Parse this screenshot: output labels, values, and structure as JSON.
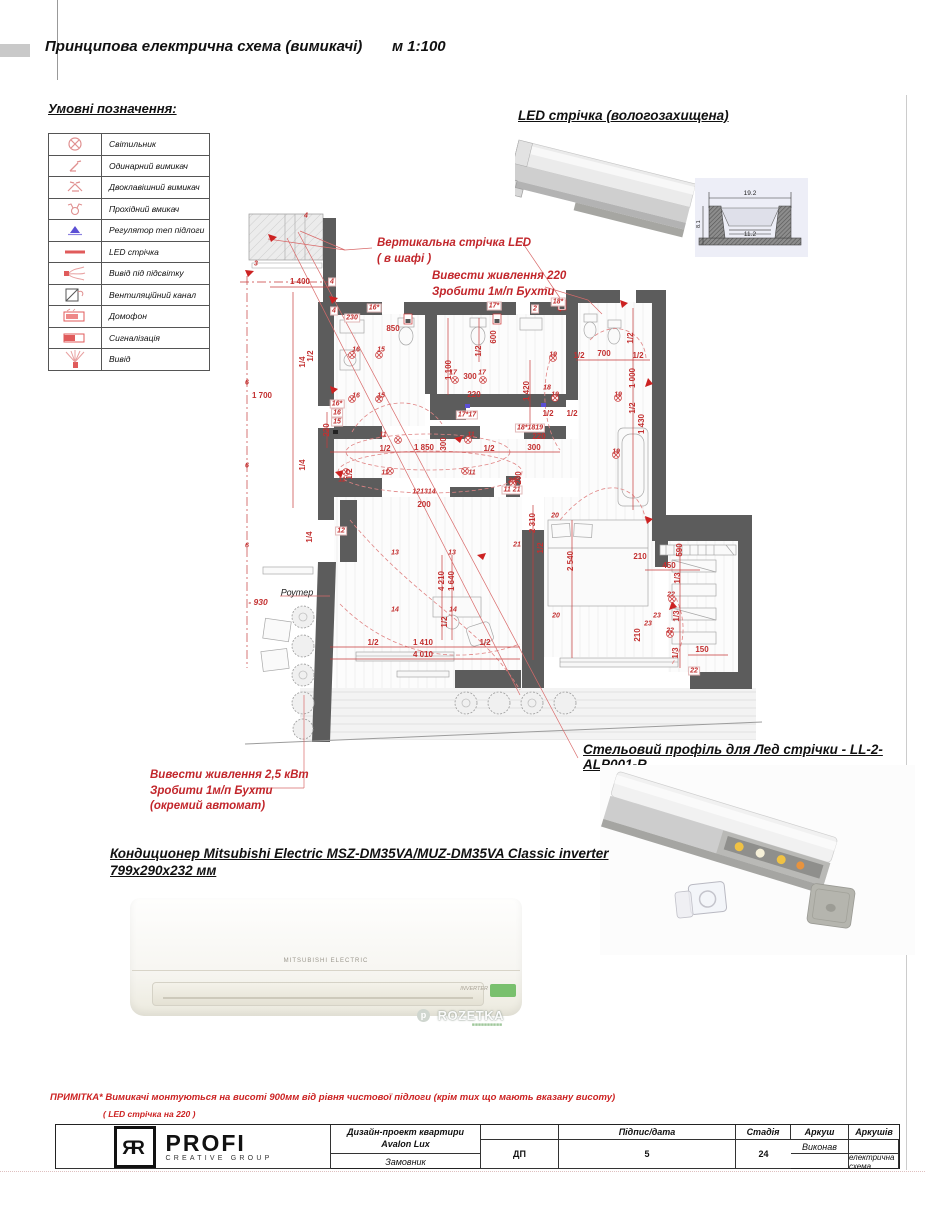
{
  "page": {
    "title": "Принципова електрична схема (вимикачі)",
    "scale": "м 1:100"
  },
  "legend": {
    "title": "Умовні позначення:",
    "items": [
      {
        "icon": "light-fixture-icon",
        "label": "Світильник"
      },
      {
        "icon": "single-switch-icon",
        "label": "Одинарний вимикач"
      },
      {
        "icon": "double-switch-icon",
        "label": "Двоклавішний вимикач"
      },
      {
        "icon": "pass-switch-icon",
        "label": "Прохідний вмикач"
      },
      {
        "icon": "floor-heating-regulator-icon",
        "label": "Регулятор теп підлоги"
      },
      {
        "icon": "led-strip-icon",
        "label": "LED стрічка"
      },
      {
        "icon": "backlight-output-icon",
        "label": "Вивід під підсвітку"
      },
      {
        "icon": "vent-channel-icon",
        "label": "Вентиляційний канал"
      },
      {
        "icon": "intercom-icon",
        "label": "Домофон"
      },
      {
        "icon": "alarm-icon",
        "label": "Сигналізація"
      },
      {
        "icon": "output-icon",
        "label": "Вивід"
      }
    ]
  },
  "led_strip": {
    "heading": "LED стрічка (вологозахищена)",
    "cross_section": {
      "width_top": "19.2",
      "width_inner": "11.2",
      "height": "8.1"
    }
  },
  "ceiling_profile": {
    "heading": "Стельовий профіль для Лед стрічки -  LL-2-ALP001-R"
  },
  "ac_unit": {
    "heading_line1": "Кондиционер Mitsubishi Electric MSZ-DM35VA/MUZ-DM35VA Classic inverter",
    "heading_line2": "799х290х232 мм",
    "brand": "MITSUBISHI ELECTRIC",
    "inverter_label": "INVERTER",
    "watermark": "ROZETKA"
  },
  "note": {
    "line1": "ПРИМІТКА*  Вимикачі монтуються на висоті 900мм від рівня чистової підлоги (крім тих що мають вказану висоту)",
    "line2": "( LED стрічка на 220 )"
  },
  "title_block": {
    "logo_monogram": "ЯR",
    "logo_name": "PROFI",
    "logo_sub": "CREATIVE GROUP",
    "executor_label": "Виконав",
    "customer_label": "Замовник",
    "signature_label": "Підпис/дата",
    "project_line1": "Дизайн-проект квартири",
    "project_line2": "Avalon Lux",
    "sheet_title": "Принципова електрична схема (вимикачі)",
    "stage_label": "Стадія",
    "stage_value": "ДП",
    "sheet_label": "Аркуш",
    "sheet_value": "5",
    "sheets_label": "Аркушів",
    "sheets_value": "24"
  },
  "plan": {
    "router_label": "Роутер",
    "level_label": "- 930",
    "callouts": [
      {
        "id": "vertical-led",
        "lines": [
          "Вертикальна стрічка LED",
          "( в шафі )"
        ]
      },
      {
        "id": "power-220",
        "lines": [
          "Вивести живлення 220",
          "Зробити 1м/п Бухти"
        ]
      },
      {
        "id": "power-25",
        "lines": [
          "Вивести живлення 2,5 кВт",
          "Зробити 1м/п Бухти",
          "(окремий автомат)"
        ]
      }
    ],
    "labels": [
      {
        "x": 300,
        "y": 282,
        "t": "1 400"
      },
      {
        "x": 352,
        "y": 318,
        "t": "230",
        "k": "bx"
      },
      {
        "x": 393,
        "y": 329,
        "t": "850"
      },
      {
        "x": 262,
        "y": 396,
        "t": "1 700"
      },
      {
        "x": 604,
        "y": 354,
        "t": "700"
      },
      {
        "x": 579,
        "y": 356,
        "t": "1/2"
      },
      {
        "x": 638,
        "y": 356,
        "t": "1/2"
      },
      {
        "x": 470,
        "y": 377,
        "t": "300"
      },
      {
        "x": 474,
        "y": 395,
        "t": "220"
      },
      {
        "x": 424,
        "y": 448,
        "t": "1 850"
      },
      {
        "x": 385,
        "y": 449,
        "t": "1/2"
      },
      {
        "x": 489,
        "y": 449,
        "t": "1/2"
      },
      {
        "x": 548,
        "y": 414,
        "t": "1/2"
      },
      {
        "x": 572,
        "y": 414,
        "t": "1/2"
      },
      {
        "x": 539,
        "y": 437,
        "t": "220"
      },
      {
        "x": 534,
        "y": 448,
        "t": "300"
      },
      {
        "x": 424,
        "y": 505,
        "t": "200"
      },
      {
        "x": 640,
        "y": 557,
        "t": "210"
      },
      {
        "x": 669,
        "y": 566,
        "t": "450"
      },
      {
        "x": 702,
        "y": 650,
        "t": "150"
      },
      {
        "x": 373,
        "y": 643,
        "t": "1/2"
      },
      {
        "x": 423,
        "y": 643,
        "t": "1 410"
      },
      {
        "x": 485,
        "y": 643,
        "t": "1/2"
      },
      {
        "x": 423,
        "y": 655,
        "t": "4 010"
      },
      {
        "x": 449,
        "y": 370,
        "t": "1 100",
        "v": 1
      },
      {
        "x": 479,
        "y": 351,
        "t": "1/2",
        "v": 1
      },
      {
        "x": 494,
        "y": 337,
        "t": "600",
        "v": 1
      },
      {
        "x": 327,
        "y": 430,
        "t": "220",
        "v": 1
      },
      {
        "x": 340,
        "y": 417,
        "t": "300",
        "v": 1
      },
      {
        "x": 311,
        "y": 356,
        "t": "1/2",
        "v": 1
      },
      {
        "x": 303,
        "y": 362,
        "t": "1/4",
        "v": 1
      },
      {
        "x": 303,
        "y": 465,
        "t": "1/4",
        "v": 1
      },
      {
        "x": 310,
        "y": 537,
        "t": "1/4",
        "v": 1
      },
      {
        "x": 350,
        "y": 474,
        "t": "1/2",
        "v": 1
      },
      {
        "x": 444,
        "y": 444,
        "t": "300",
        "v": 1
      },
      {
        "x": 527,
        "y": 391,
        "t": "1 420",
        "v": 1
      },
      {
        "x": 631,
        "y": 338,
        "t": "1/2",
        "v": 1
      },
      {
        "x": 633,
        "y": 378,
        "t": "1 000",
        "v": 1
      },
      {
        "x": 633,
        "y": 408,
        "t": "1/2",
        "v": 1
      },
      {
        "x": 642,
        "y": 424,
        "t": "1 430",
        "v": 1
      },
      {
        "x": 519,
        "y": 478,
        "t": "200",
        "v": 1
      },
      {
        "x": 533,
        "y": 523,
        "t": "2 310",
        "v": 1
      },
      {
        "x": 541,
        "y": 548,
        "t": "1/2",
        "v": 1
      },
      {
        "x": 571,
        "y": 561,
        "t": "2 540",
        "v": 1
      },
      {
        "x": 442,
        "y": 581,
        "t": "4 210",
        "v": 1
      },
      {
        "x": 452,
        "y": 581,
        "t": "1 640",
        "v": 1
      },
      {
        "x": 445,
        "y": 622,
        "t": "1/2",
        "v": 1
      },
      {
        "x": 680,
        "y": 550,
        "t": "590",
        "v": 1
      },
      {
        "x": 678,
        "y": 578,
        "t": "1/3",
        "v": 1
      },
      {
        "x": 677,
        "y": 616,
        "t": "1/3",
        "v": 1
      },
      {
        "x": 676,
        "y": 653,
        "t": "1/3",
        "v": 1
      },
      {
        "x": 638,
        "y": 635,
        "t": "210",
        "v": 1
      },
      {
        "x": 374,
        "y": 308,
        "t": "16*",
        "k": "bx"
      },
      {
        "x": 494,
        "y": 306,
        "t": "17*",
        "k": "bx"
      },
      {
        "x": 558,
        "y": 302,
        "t": "18*",
        "k": "bx"
      },
      {
        "x": 535,
        "y": 309,
        "t": "2",
        "k": "bx"
      },
      {
        "x": 306,
        "y": 216,
        "t": "4",
        "k": "b"
      },
      {
        "x": 256,
        "y": 264,
        "t": "3",
        "k": "b"
      },
      {
        "x": 332,
        "y": 282,
        "t": "4",
        "k": "bx"
      },
      {
        "x": 334,
        "y": 311,
        "t": "4",
        "k": "bx"
      },
      {
        "x": 356,
        "y": 350,
        "t": "16",
        "k": "b"
      },
      {
        "x": 381,
        "y": 350,
        "t": "15",
        "k": "b"
      },
      {
        "x": 356,
        "y": 396,
        "t": "16",
        "k": "b"
      },
      {
        "x": 381,
        "y": 396,
        "t": "15",
        "k": "b"
      },
      {
        "x": 337,
        "y": 404,
        "t": "16*",
        "k": "bx"
      },
      {
        "x": 337,
        "y": 413,
        "t": "16",
        "k": "bx"
      },
      {
        "x": 337,
        "y": 422,
        "t": "15",
        "k": "bx"
      },
      {
        "x": 453,
        "y": 373,
        "t": "17",
        "k": "b"
      },
      {
        "x": 482,
        "y": 373,
        "t": "17",
        "k": "b"
      },
      {
        "x": 467,
        "y": 415,
        "t": "17*17",
        "k": "bx"
      },
      {
        "x": 547,
        "y": 388,
        "t": "18",
        "k": "b"
      },
      {
        "x": 553,
        "y": 355,
        "t": "19",
        "k": "b"
      },
      {
        "x": 555,
        "y": 395,
        "t": "19",
        "k": "b"
      },
      {
        "x": 618,
        "y": 395,
        "t": "19",
        "k": "b"
      },
      {
        "x": 616,
        "y": 452,
        "t": "19",
        "k": "b"
      },
      {
        "x": 530,
        "y": 428,
        "t": "18*1819",
        "k": "bx"
      },
      {
        "x": 383,
        "y": 435,
        "t": "11",
        "k": "b"
      },
      {
        "x": 471,
        "y": 435,
        "t": "11",
        "k": "b"
      },
      {
        "x": 342,
        "y": 480,
        "t": "11",
        "k": "b"
      },
      {
        "x": 385,
        "y": 473,
        "t": "11",
        "k": "b"
      },
      {
        "x": 472,
        "y": 473,
        "t": "11",
        "k": "b"
      },
      {
        "x": 424,
        "y": 492,
        "t": "121314",
        "k": "b"
      },
      {
        "x": 512,
        "y": 481,
        "t": "20",
        "k": "b"
      },
      {
        "x": 512,
        "y": 490,
        "t": "11 21",
        "k": "bx"
      },
      {
        "x": 395,
        "y": 553,
        "t": "13",
        "k": "b"
      },
      {
        "x": 452,
        "y": 553,
        "t": "13",
        "k": "b"
      },
      {
        "x": 395,
        "y": 610,
        "t": "14",
        "k": "b"
      },
      {
        "x": 453,
        "y": 610,
        "t": "14",
        "k": "b"
      },
      {
        "x": 341,
        "y": 531,
        "t": "12",
        "k": "bx"
      },
      {
        "x": 517,
        "y": 545,
        "t": "21",
        "k": "b"
      },
      {
        "x": 555,
        "y": 516,
        "t": "20",
        "k": "b"
      },
      {
        "x": 556,
        "y": 616,
        "t": "20",
        "k": "b"
      },
      {
        "x": 671,
        "y": 595,
        "t": "22",
        "k": "b"
      },
      {
        "x": 670,
        "y": 631,
        "t": "22",
        "k": "b"
      },
      {
        "x": 694,
        "y": 671,
        "t": "22",
        "k": "bx"
      },
      {
        "x": 657,
        "y": 616,
        "t": "23",
        "k": "b"
      },
      {
        "x": 648,
        "y": 624,
        "t": "23",
        "k": "b"
      },
      {
        "x": 247,
        "y": 383,
        "t": "6",
        "k": "b"
      },
      {
        "x": 247,
        "y": 466,
        "t": "6",
        "k": "b"
      },
      {
        "x": 247,
        "y": 546,
        "t": "6",
        "k": "b"
      }
    ]
  }
}
